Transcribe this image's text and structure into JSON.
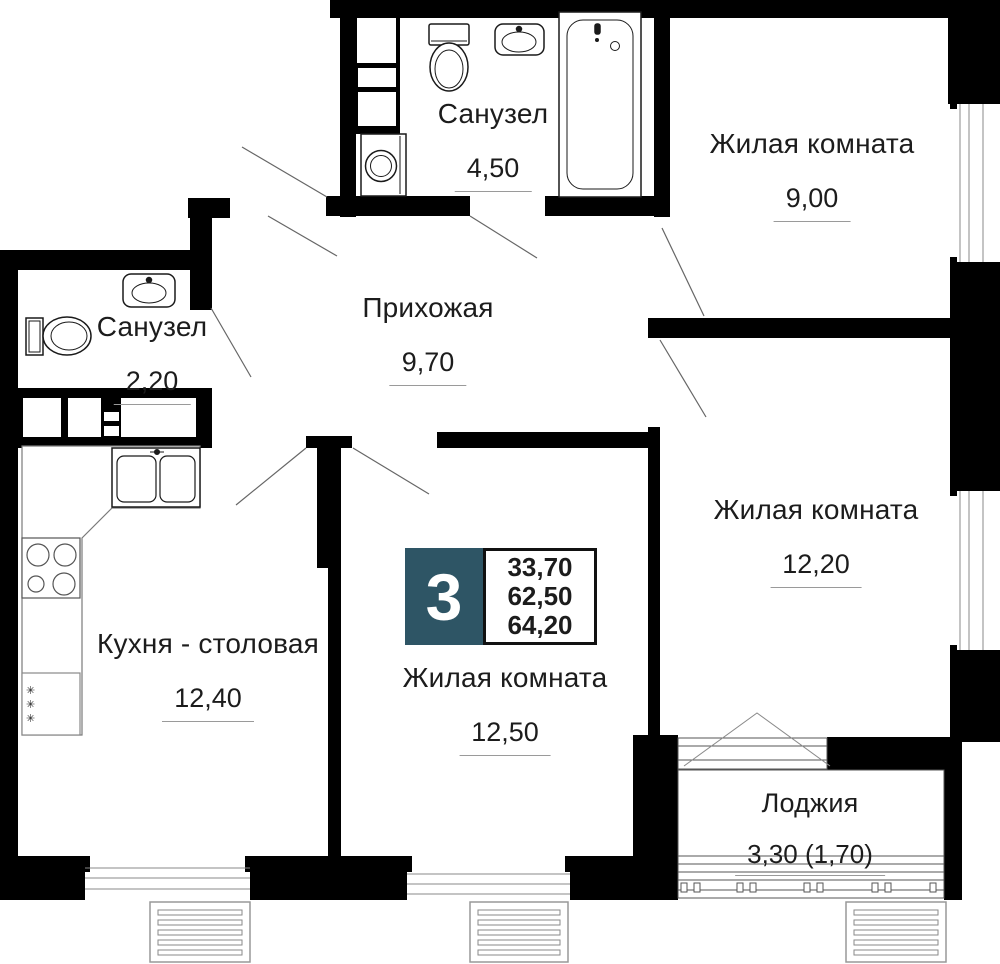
{
  "plan": {
    "badge": {
      "rooms_count": "3",
      "areas": {
        "living": "33,70",
        "middle": "62,50",
        "total": "64,20"
      },
      "accent_color": "#2E5565"
    },
    "rooms": [
      {
        "name": "Санузел",
        "area": "4,50"
      },
      {
        "name": "Жилая комната",
        "area": "9,00"
      },
      {
        "name": "Прихожая",
        "area": "9,70"
      },
      {
        "name": "Санузел",
        "area": "2,20"
      },
      {
        "name": "Кухня - столовая",
        "area": "12,40"
      },
      {
        "name": "Жилая комната",
        "area": "12,50"
      },
      {
        "name": "Жилая комната",
        "area": "12,20"
      },
      {
        "name": "Лоджия",
        "area": "3,30 (1,70)"
      }
    ],
    "icons": {
      "snowflake": "✳"
    }
  }
}
